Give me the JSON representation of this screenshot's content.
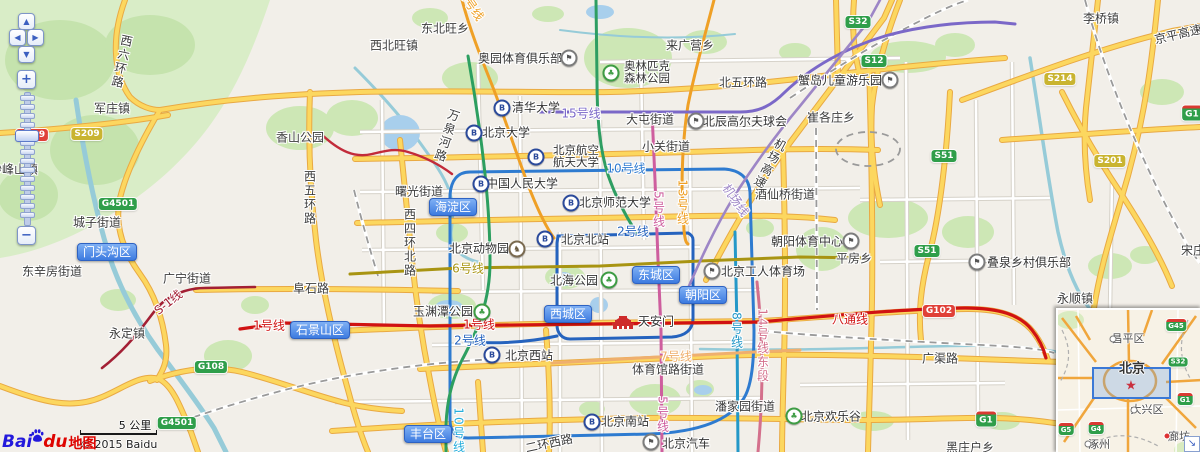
{
  "attribution": {
    "logo_bai": "Bai",
    "logo_du": "du",
    "logo_map_word": "地图",
    "copyright": "© 2015 Baidu"
  },
  "scale_bar": {
    "label": "5 公里"
  },
  "controls": {
    "pan_up": "▲",
    "pan_left": "◀",
    "pan_right": "▶",
    "pan_down": "▼",
    "zoom_in": "+",
    "zoom_out": "−"
  },
  "colors": {
    "district_badge": "#3D7BE0",
    "shield_green": "#2F9E4A",
    "shield_yellow": "#C9B430",
    "shield_red": "#E04038",
    "line1_red": "#D01212",
    "line2_blue": "#2563BE",
    "line5_pink": "#CE5E9E",
    "line10_blue": "#2E7BD0",
    "line13_orange": "#EFA026",
    "line15_purple": "#7B68C8",
    "water": "#96CBD8",
    "road_yellow": "#FCD75F",
    "park_green": "#CDE7B5"
  },
  "map": {
    "districts": [
      {
        "t": "门头沟区",
        "x": 107,
        "y": 252
      },
      {
        "t": "石景山区",
        "x": 320,
        "y": 330
      },
      {
        "t": "海淀区",
        "x": 453,
        "y": 207
      },
      {
        "t": "西城区",
        "x": 568,
        "y": 314
      },
      {
        "t": "东城区",
        "x": 656,
        "y": 275
      },
      {
        "t": "朝阳区",
        "x": 703,
        "y": 295
      },
      {
        "t": "丰台区",
        "x": 428,
        "y": 434
      }
    ],
    "shields": [
      {
        "t": "G109",
        "s": "r",
        "x": 32,
        "y": 135
      },
      {
        "t": "S209",
        "s": "y",
        "x": 87,
        "y": 134
      },
      {
        "t": "G4501",
        "s": "g",
        "x": 118,
        "y": 204
      },
      {
        "t": "G4501",
        "s": "g",
        "x": 177,
        "y": 423
      },
      {
        "t": "G108",
        "s": "g",
        "x": 211,
        "y": 367
      },
      {
        "t": "S32",
        "s": "g",
        "x": 858,
        "y": 22
      },
      {
        "t": "S12",
        "s": "g",
        "x": 874,
        "y": 61
      },
      {
        "t": "S51",
        "s": "g",
        "x": 944,
        "y": 156
      },
      {
        "t": "S51",
        "s": "g",
        "x": 927,
        "y": 251
      },
      {
        "t": "S214",
        "s": "y",
        "x": 1060,
        "y": 79
      },
      {
        "t": "S201",
        "s": "y",
        "x": 1110,
        "y": 161
      },
      {
        "t": "G1",
        "s": "cap",
        "x": 1192,
        "y": 113
      },
      {
        "t": "G102",
        "s": "r",
        "x": 939,
        "y": 311
      },
      {
        "t": "G1",
        "s": "cap",
        "x": 986,
        "y": 419
      }
    ],
    "subway_labels": [
      {
        "t": "1号线",
        "c": "#D01212",
        "x": 269,
        "y": 325
      },
      {
        "t": "1号线",
        "c": "#D01212",
        "x": 479,
        "y": 324
      },
      {
        "t": "八通线",
        "c": "#D01212",
        "x": 850,
        "y": 319
      },
      {
        "t": "2号线",
        "c": "#2563BE",
        "x": 633,
        "y": 231
      },
      {
        "t": "2号线",
        "c": "#2563BE",
        "x": 470,
        "y": 340
      },
      {
        "t": "10号线",
        "c": "#2E7BD0",
        "x": 626,
        "y": 168
      },
      {
        "t": "10号线",
        "c": "#28AEDB",
        "x": 459,
        "y": 431,
        "v": true
      },
      {
        "t": "15号线",
        "c": "#7B68C8",
        "x": 581,
        "y": 113
      },
      {
        "t": "5号线",
        "c": "#CE5E9E",
        "x": 659,
        "y": 210,
        "v": true
      },
      {
        "t": "5号线",
        "c": "#CE5E9E",
        "x": 663,
        "y": 415,
        "v": true
      },
      {
        "t": "13号线",
        "c": "#EFA026",
        "x": 683,
        "y": 203,
        "v": true
      },
      {
        "t": "13号线",
        "c": "#EFA026",
        "x": 470,
        "y": 3,
        "a": 55
      },
      {
        "t": "6号线",
        "c": "#A89412",
        "x": 468,
        "y": 268
      },
      {
        "t": "7号线",
        "c": "#EFAF6E",
        "x": 676,
        "y": 356
      },
      {
        "t": "8号线",
        "c": "#2498C8",
        "x": 737,
        "y": 331,
        "v": true
      },
      {
        "t": "14号线东段",
        "c": "#D4708C",
        "x": 763,
        "y": 346,
        "v": true
      },
      {
        "t": "S-1线",
        "c": "#A31F34",
        "x": 168,
        "y": 302,
        "a": -38
      },
      {
        "t": "机场线",
        "c": "#9D86C6",
        "x": 736,
        "y": 200,
        "a": 55
      }
    ],
    "road_labels": [
      {
        "t": "西六环路",
        "x": 122,
        "y": 62,
        "v": true,
        "a": 12
      },
      {
        "t": "北五环路",
        "x": 743,
        "y": 82
      },
      {
        "t": "京平高速",
        "x": 1178,
        "y": 34,
        "a": -13
      },
      {
        "t": "机场高速",
        "x": 770,
        "y": 164,
        "v": true,
        "a": 28
      },
      {
        "t": "阜石路",
        "x": 311,
        "y": 288
      },
      {
        "t": "广渠路",
        "x": 940,
        "y": 358
      },
      {
        "t": "万泉河路",
        "x": 447,
        "y": 136,
        "v": true,
        "a": 18
      },
      {
        "t": "西五环路",
        "x": 310,
        "y": 198,
        "v": true
      },
      {
        "t": "西四环北路",
        "x": 410,
        "y": 243,
        "v": true
      },
      {
        "t": "二环西路",
        "x": 549,
        "y": 443,
        "a": -12
      }
    ],
    "places": [
      {
        "t": "军庄镇",
        "x": 112,
        "y": 108
      },
      {
        "t": "妙峰山镇",
        "x": 14,
        "y": 169
      },
      {
        "t": "城子街道",
        "x": 97,
        "y": 222
      },
      {
        "t": "东辛房街道",
        "x": 52,
        "y": 271
      },
      {
        "t": "广宁街道",
        "x": 187,
        "y": 278
      },
      {
        "t": "永定镇",
        "x": 127,
        "y": 333
      },
      {
        "t": "香山公园",
        "x": 300,
        "y": 137
      },
      {
        "t": "东北旺乡",
        "x": 445,
        "y": 28
      },
      {
        "t": "西北旺镇",
        "x": 394,
        "y": 45
      },
      {
        "t": "来广营乡",
        "x": 690,
        "y": 45
      },
      {
        "t": "大屯街道",
        "x": 650,
        "y": 119
      },
      {
        "t": "小关街道",
        "x": 666,
        "y": 146
      },
      {
        "t": "崔各庄乡",
        "x": 831,
        "y": 117
      },
      {
        "t": "李桥镇",
        "x": 1101,
        "y": 18
      },
      {
        "t": "曙光街道",
        "x": 419,
        "y": 191
      },
      {
        "t": "酒仙桥街道",
        "x": 785,
        "y": 194
      },
      {
        "t": "平房乡",
        "x": 854,
        "y": 258
      },
      {
        "t": "体育馆路街道",
        "x": 668,
        "y": 369
      },
      {
        "t": "潘家园街道",
        "x": 745,
        "y": 406
      },
      {
        "t": "黑庄户乡",
        "x": 970,
        "y": 447
      },
      {
        "t": "永顺镇",
        "x": 1075,
        "y": 298
      },
      {
        "t": "宋庄",
        "x": 1193,
        "y": 250
      }
    ],
    "pois": [
      {
        "t": "奥园体育俱乐部",
        "i": "flag",
        "ix": 569,
        "iy": 58,
        "tx": 520,
        "ty": 58
      },
      {
        "lines": [
          "奥林匹克",
          "森林公园"
        ],
        "i": "park",
        "ix": 611,
        "iy": 73,
        "tx": 647,
        "ty": 72
      },
      {
        "t": "清华大学",
        "i": "subway",
        "ix": 502,
        "iy": 108,
        "tx": 536,
        "ty": 107
      },
      {
        "t": "北京大学",
        "i": "subway",
        "ix": 474,
        "iy": 133,
        "tx": 506,
        "ty": 132
      },
      {
        "lines": [
          "北京航空",
          "航天大学"
        ],
        "i": "subway",
        "ix": 536,
        "iy": 157,
        "tx": 576,
        "ty": 156
      },
      {
        "t": "中国人民大学",
        "i": "subway",
        "ix": 481,
        "iy": 184,
        "tx": 522,
        "ty": 183
      },
      {
        "t": "北京师范大学",
        "i": "subway",
        "ix": 571,
        "iy": 203,
        "tx": 615,
        "ty": 202
      },
      {
        "t": "北京北站",
        "i": "subway",
        "ix": 545,
        "iy": 239,
        "tx": 585,
        "ty": 239
      },
      {
        "t": "北京动物园",
        "i": "zoo",
        "ix": 517,
        "iy": 249,
        "tx": 479,
        "ty": 248
      },
      {
        "t": "北海公园",
        "i": "park",
        "ix": 609,
        "iy": 280,
        "tx": 574,
        "ty": 280
      },
      {
        "t": "玉渊潭公园",
        "i": "park",
        "ix": 482,
        "iy": 312,
        "tx": 443,
        "ty": 311
      },
      {
        "t": "天安门",
        "i": "tiananmen",
        "ix": 623,
        "iy": 322,
        "tx": 656,
        "ty": 321
      },
      {
        "t": "北京工人体育场",
        "i": "flag",
        "ix": 712,
        "iy": 271,
        "tx": 763,
        "ty": 271
      },
      {
        "t": "朝阳体育中心",
        "i": "flag",
        "ix": 851,
        "iy": 241,
        "tx": 807,
        "ty": 241
      },
      {
        "t": "蟹岛儿童游乐园",
        "i": "flag",
        "ix": 890,
        "iy": 80,
        "tx": 840,
        "ty": 80
      },
      {
        "t": "北辰高尔夫球会",
        "i": "flag",
        "ix": 696,
        "iy": 121,
        "tx": 745,
        "ty": 121
      },
      {
        "t": "北京西站",
        "i": "subway",
        "ix": 492,
        "iy": 355,
        "tx": 529,
        "ty": 355
      },
      {
        "t": "北京南站",
        "i": "subway",
        "ix": 592,
        "iy": 422,
        "tx": 625,
        "ty": 421
      },
      {
        "t": "北京欢乐谷",
        "i": "park",
        "ix": 794,
        "iy": 416,
        "tx": 831,
        "ty": 416
      },
      {
        "t": "北京汽车",
        "i": "flag",
        "ix": 651,
        "iy": 442,
        "tx": 686,
        "ty": 443
      },
      {
        "t": "叠泉乡村俱乐部",
        "i": "flag",
        "ix": 977,
        "iy": 262,
        "tx": 1029,
        "ty": 262
      }
    ]
  },
  "inset": {
    "city": {
      "t": "北京",
      "x": 74,
      "y": 57
    },
    "star": {
      "x": 73,
      "y": 76
    },
    "selection_rect": {
      "x": 34,
      "y": 57,
      "w": 75,
      "h": 28
    },
    "places": [
      {
        "t": "昌平区",
        "x": 70,
        "y": 28,
        "dx": 55,
        "dy": 29
      },
      {
        "t": "大兴区",
        "x": 89,
        "y": 99,
        "dx": 76,
        "dy": 100
      },
      {
        "t": "涿州",
        "x": 41,
        "y": 134,
        "dx": 30,
        "dy": 134
      },
      {
        "t": "廊坊",
        "x": 121,
        "y": 126,
        "dx": 109,
        "dy": 126,
        "red": true
      }
    ],
    "shields": [
      {
        "t": "G45",
        "s": "cap",
        "x": 118,
        "y": 15
      },
      {
        "t": "S32",
        "s": "g",
        "x": 120,
        "y": 52
      },
      {
        "t": "G1",
        "s": "cap",
        "x": 127,
        "y": 89
      },
      {
        "t": "G5",
        "s": "cap",
        "x": 8,
        "y": 119
      },
      {
        "t": "G4",
        "s": "cap",
        "x": 38,
        "y": 118
      }
    ],
    "collapse_icon": "↘"
  }
}
